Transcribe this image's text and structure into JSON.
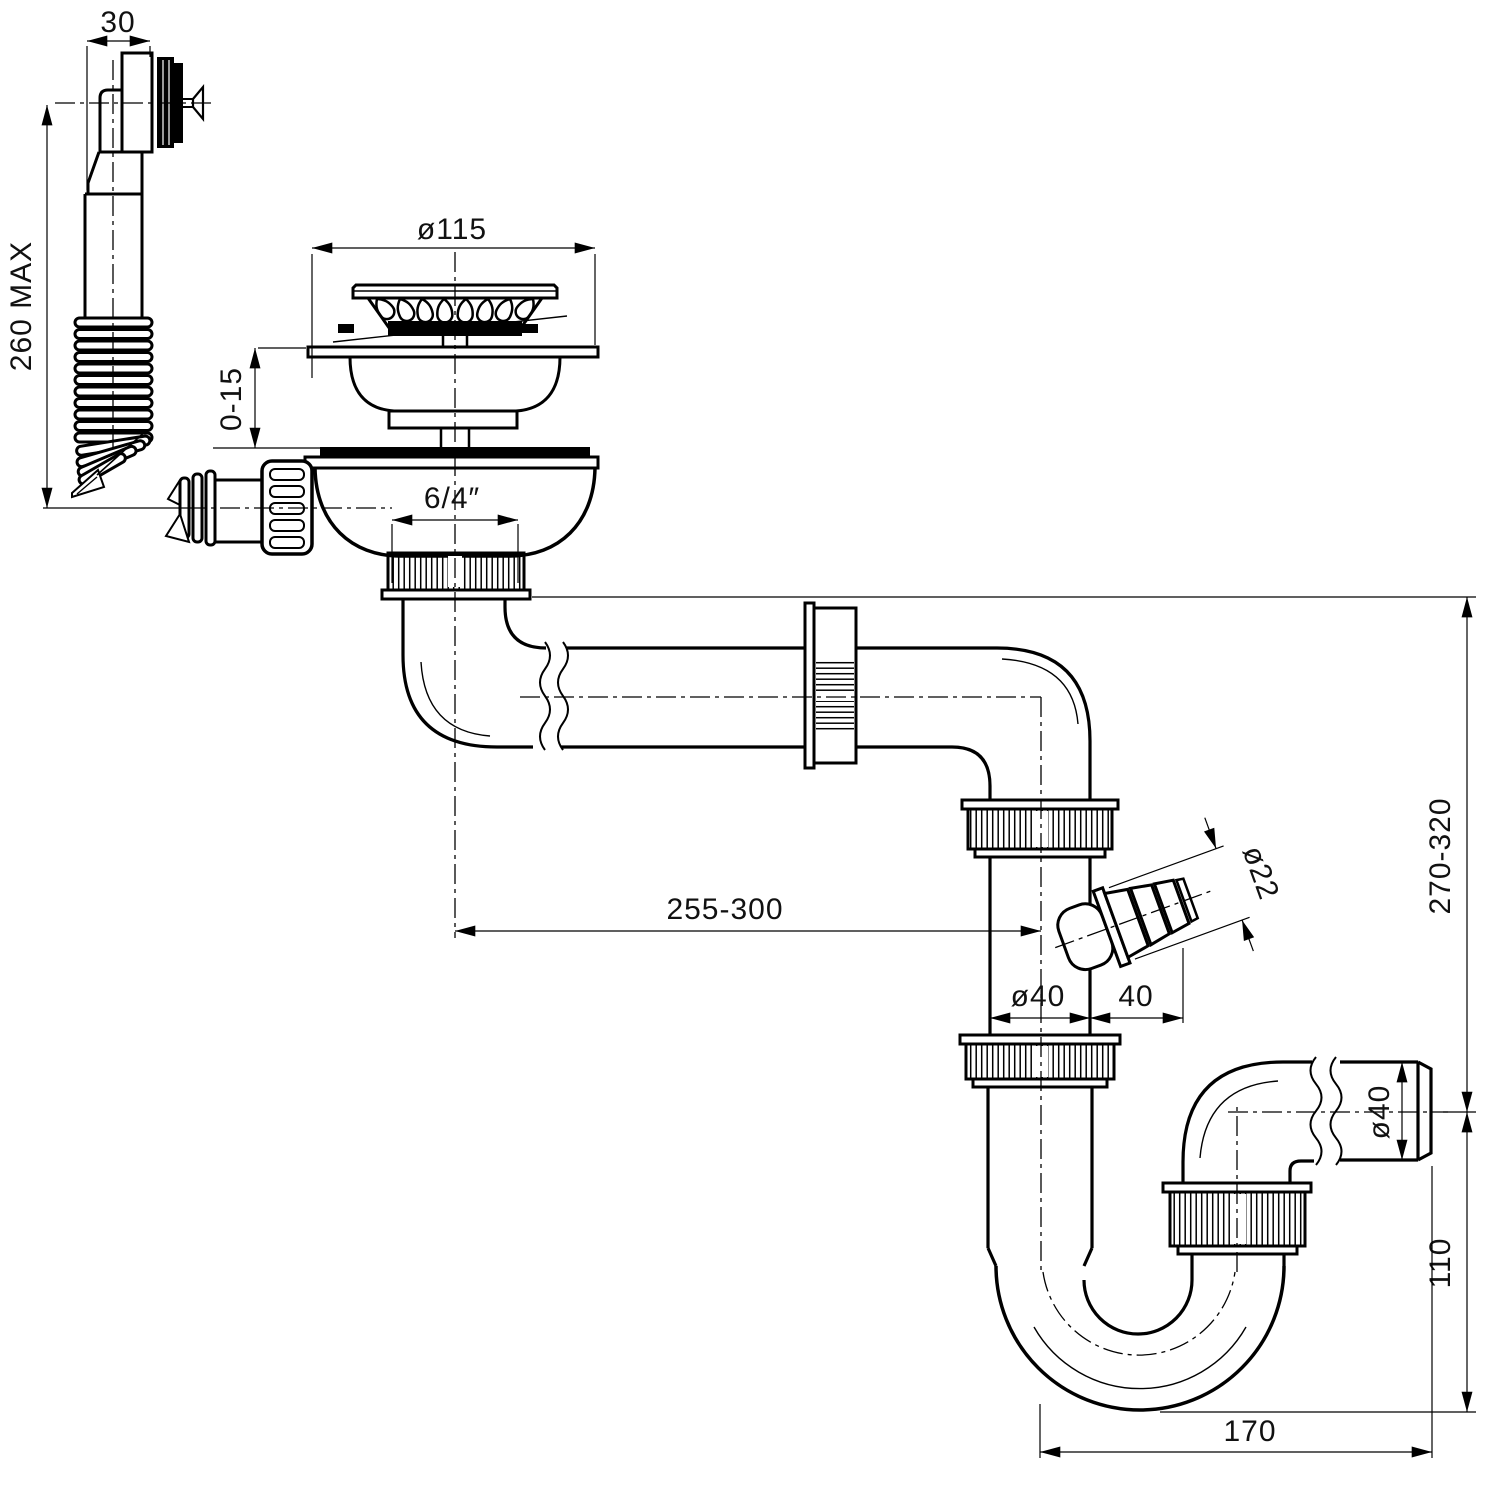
{
  "drawing": {
    "colors": {
      "line": "#000000",
      "background": "#ffffff"
    },
    "dims": {
      "overflow_head_width": "30",
      "overflow_hose_length": "260 MAX",
      "strainer_flange_diameter": "ø115",
      "sink_thickness_range": "0-15",
      "thread_size": "6/4″",
      "horizontal_offset_range": "255-300",
      "riser_pipe_diameter": "ø40",
      "branch_offset": "40",
      "branch_hose_diameter": "ø22",
      "installation_height_range": "270-320",
      "trap_depth": "110",
      "outlet_pipe_diameter": "ø40",
      "trap_horizontal_reach": "170"
    }
  }
}
